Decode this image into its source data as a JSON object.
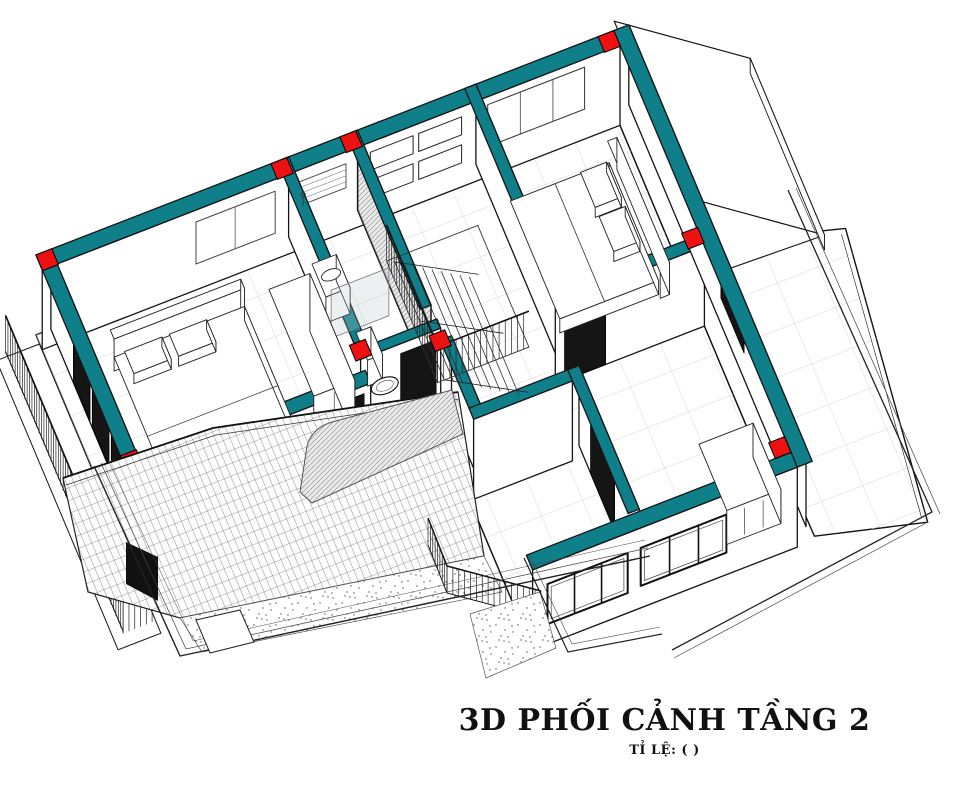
{
  "drawing": {
    "title": "3D PHỐI CẢNH TẦNG 2",
    "scale_label": "TỈ LỆ: ( )"
  },
  "colors": {
    "wall_cut": "#0f7f8a",
    "column": "#ee1111",
    "line": "#141414",
    "grid": "#d2d6db",
    "hatch": "#888888",
    "glass_dark": "#151515",
    "background": "#ffffff"
  },
  "visible_components": [
    "teal-cut-walls",
    "red-column-markers",
    "bedroom-1-bed",
    "bedroom-1-wardrobe",
    "bedroom-2-bed",
    "bathroom-toilet",
    "bathroom-sink",
    "bathroom-shower-glass",
    "staircase-with-railing",
    "left-balcony-railing",
    "front-balcony-railing",
    "tiled-sloped-roof",
    "gravel-strips",
    "roof-terrace-tiles",
    "white-roof-volume",
    "window-openings",
    "door-openings",
    "curved-canopy-hatch"
  ]
}
